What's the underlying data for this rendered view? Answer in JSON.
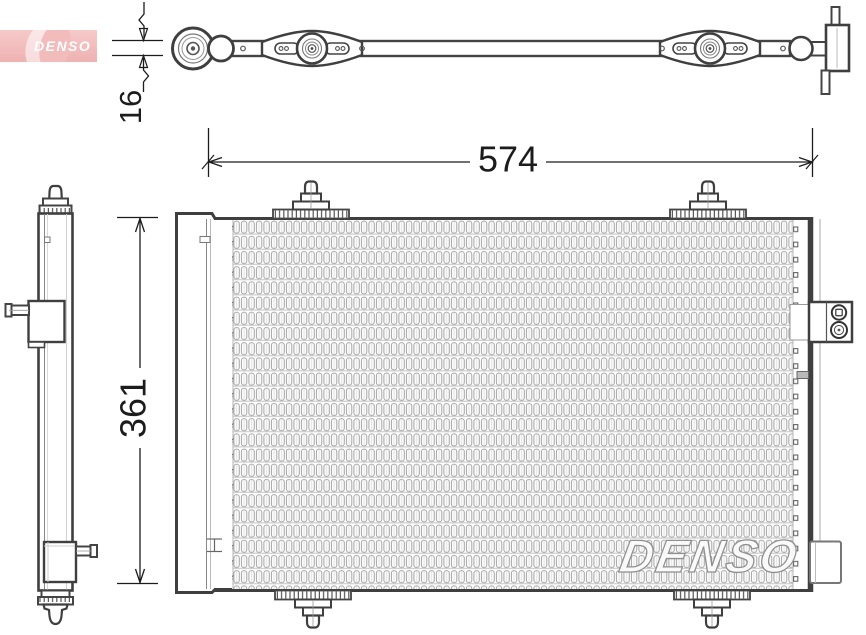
{
  "logo": {
    "text": "DENSO",
    "bg_color": "#f2bcbc",
    "text_color": "#ffffff"
  },
  "watermark": {
    "text": "DENSO"
  },
  "dimensions": {
    "width": {
      "label": "574"
    },
    "height": {
      "label": "361"
    },
    "depth": {
      "label": "16"
    }
  },
  "colors": {
    "outline": "#3f3f3f",
    "fin_stroke": "#a6a6a6",
    "watermark_stroke": "#909090",
    "dimension_text": "#1c1c1c"
  }
}
